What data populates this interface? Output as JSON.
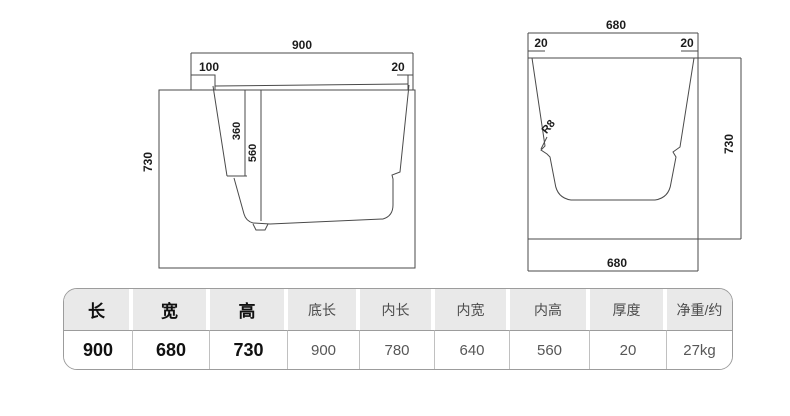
{
  "side_view": {
    "overall_length": "900",
    "deck_left_width": "100",
    "deck_right_width": "20",
    "height": "730",
    "seat_depth": "360",
    "inner_depth": "560"
  },
  "end_view": {
    "overall_width_top": "680",
    "wall_left_thickness": "20",
    "wall_right_thickness": "20",
    "height": "730",
    "corner_radius": "R8",
    "overall_width_bottom": "680"
  },
  "spec_table": {
    "columns": [
      {
        "header": "长",
        "value": "900"
      },
      {
        "header": "宽",
        "value": "680"
      },
      {
        "header": "高",
        "value": "730"
      },
      {
        "header": "底长",
        "value": "900"
      },
      {
        "header": "内长",
        "value": "780"
      },
      {
        "header": "内宽",
        "value": "640"
      },
      {
        "header": "内高",
        "value": "560"
      },
      {
        "header": "厚度",
        "value": "20"
      },
      {
        "header": "净重/约",
        "value": "27kg"
      }
    ]
  },
  "colors": {
    "line": "#4a4a4a",
    "table_border": "#9c9c9c",
    "header_bg": "#e9e9e9",
    "text_dark": "#111111",
    "text_gray": "#575757"
  }
}
